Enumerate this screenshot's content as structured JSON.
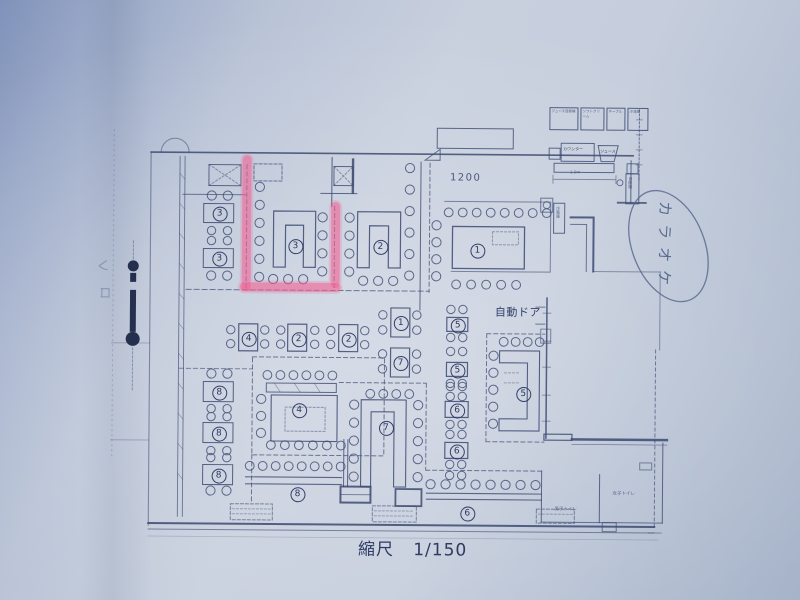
{
  "photo": {
    "paper_color": "#c6cedd",
    "ink_color": "#3c4a72",
    "highlight_color": "#f1648f"
  },
  "plan": {
    "scale_label": "縮尺   1/150",
    "dimension_label": "1200",
    "auto_door_label": "自動ドア",
    "small_dimension_label": "1.5m",
    "handwriting": {
      "karaoke": "カラオケ",
      "margin_marks": [
        "レ",
        "ロ"
      ]
    },
    "equipment_labels": [
      "ジュース自販機",
      "ソフトクリーム",
      "テーブル",
      "冷凍庫"
    ],
    "counter_labels": [
      "カウンター",
      "ジュース"
    ],
    "vertical_labels": [
      "自販機",
      "冷蔵庫"
    ],
    "toilet_labels": [
      "男子トイレ",
      "女子トイレ"
    ],
    "markers": [
      {
        "n": "3",
        "x": 218,
        "y": 214
      },
      {
        "n": "3",
        "x": 218,
        "y": 259
      },
      {
        "n": "3",
        "x": 294,
        "y": 246
      },
      {
        "n": "2",
        "x": 379,
        "y": 246
      },
      {
        "n": "1",
        "x": 476,
        "y": 249
      },
      {
        "n": "4",
        "x": 248,
        "y": 339
      },
      {
        "n": "2",
        "x": 298,
        "y": 339
      },
      {
        "n": "2",
        "x": 348,
        "y": 339
      },
      {
        "n": "1",
        "x": 400,
        "y": 322
      },
      {
        "n": "7",
        "x": 400,
        "y": 362
      },
      {
        "n": "5",
        "x": 457,
        "y": 324
      },
      {
        "n": "5",
        "x": 457,
        "y": 369
      },
      {
        "n": "5",
        "x": 523,
        "y": 392
      },
      {
        "n": "4",
        "x": 299,
        "y": 410
      },
      {
        "n": "7",
        "x": 386,
        "y": 427
      },
      {
        "n": "6",
        "x": 457,
        "y": 409
      },
      {
        "n": "6",
        "x": 457,
        "y": 450
      },
      {
        "n": "8",
        "x": 219,
        "y": 393
      },
      {
        "n": "8",
        "x": 219,
        "y": 434
      },
      {
        "n": "8",
        "x": 219,
        "y": 476
      },
      {
        "n": "8",
        "x": 298,
        "y": 494
      },
      {
        "n": "6",
        "x": 468,
        "y": 512
      }
    ]
  }
}
